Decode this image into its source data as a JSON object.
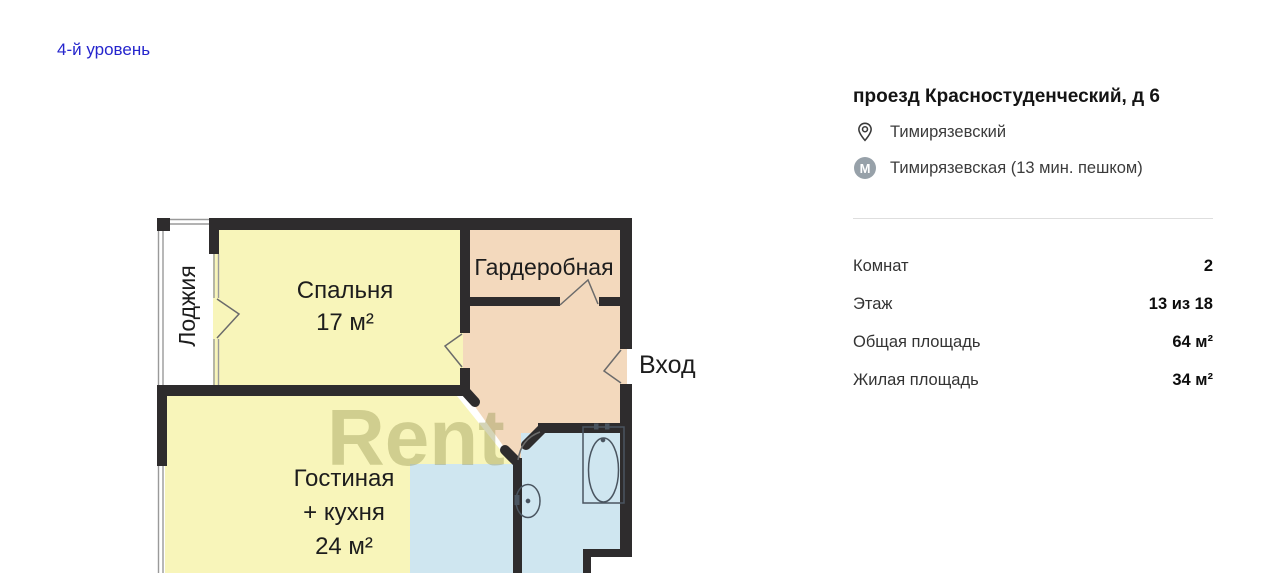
{
  "level_link": {
    "label": "4-й уровень",
    "color": "#2525cd"
  },
  "property": {
    "address": "проезд Красностуденческий, д 6",
    "district": "Тимирязевский",
    "metro": "Тимирязевская (13 мин. пешком)",
    "metro_icon_letter": "М",
    "params": [
      {
        "label": "Комнат",
        "value": "2"
      },
      {
        "label": "Этаж",
        "value": "13 из 18"
      },
      {
        "label": "Общая площадь",
        "value": "64 м²"
      },
      {
        "label": "Жилая площадь",
        "value": "34 м²"
      }
    ]
  },
  "floorplan": {
    "watermark": "Rent",
    "entrance_label": "Вход",
    "loggia_label": "Лоджия",
    "bedroom_label": "Спальня",
    "bedroom_area": "17 м²",
    "wardrobe_label": "Гардеробная",
    "living_label_line1": "Гостиная",
    "living_label_line2": "+ кухня",
    "living_area": "24 м²",
    "colors": {
      "room_yellow": "#f8f5ba",
      "room_peach": "#f3d9bd",
      "room_blue": "#cfe6f0",
      "wall": "#2e2c2d",
      "watermark": "#9b9a55",
      "fixture_stroke": "#4a5560",
      "window_line": "#9a9a9a"
    }
  }
}
